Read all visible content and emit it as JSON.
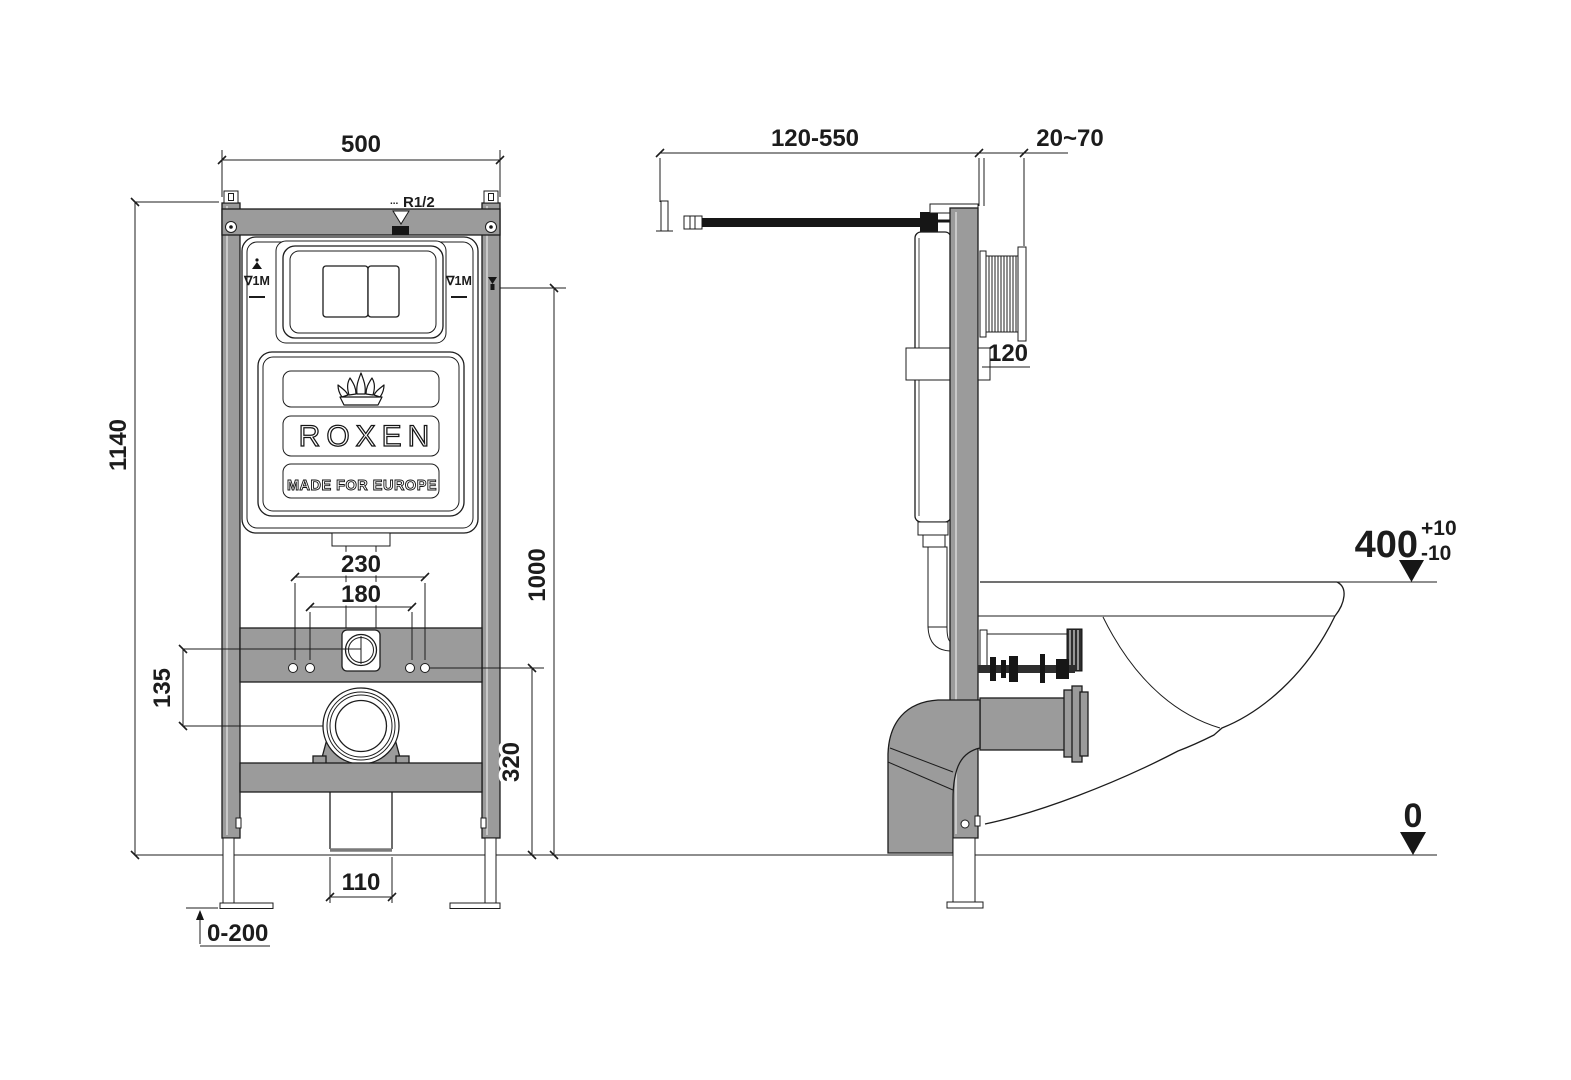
{
  "title": "ROXEN wall-hung toilet installation frame - dimensional drawing",
  "colors": {
    "frame_gray": "#9b9b9b",
    "line": "#1c1c1c",
    "background": "#ffffff"
  },
  "brand": {
    "name": "ROXEN",
    "tagline": "MADE FOR EUROPE"
  },
  "front_view": {
    "width": "500",
    "height": "1140",
    "actuator_height": "1000",
    "inlet_spacing_outer": "230",
    "inlet_spacing_inner": "180",
    "inlet_to_outlet": "135",
    "outlet_height": "320",
    "drain_width": "110",
    "leg_adjustment": "0-200",
    "supply_thread_prefix": "...",
    "supply_thread": "R1/2",
    "level_mark_left": "∇1M",
    "level_mark_right": "∇1M"
  },
  "side_view": {
    "supply_reach": "120-550",
    "wall_clearance": "20~70",
    "frame_depth": "120",
    "bowl_height": "400",
    "bowl_height_tol_plus": "+10",
    "bowl_height_tol_minus": "-10",
    "floor_level": "0"
  }
}
